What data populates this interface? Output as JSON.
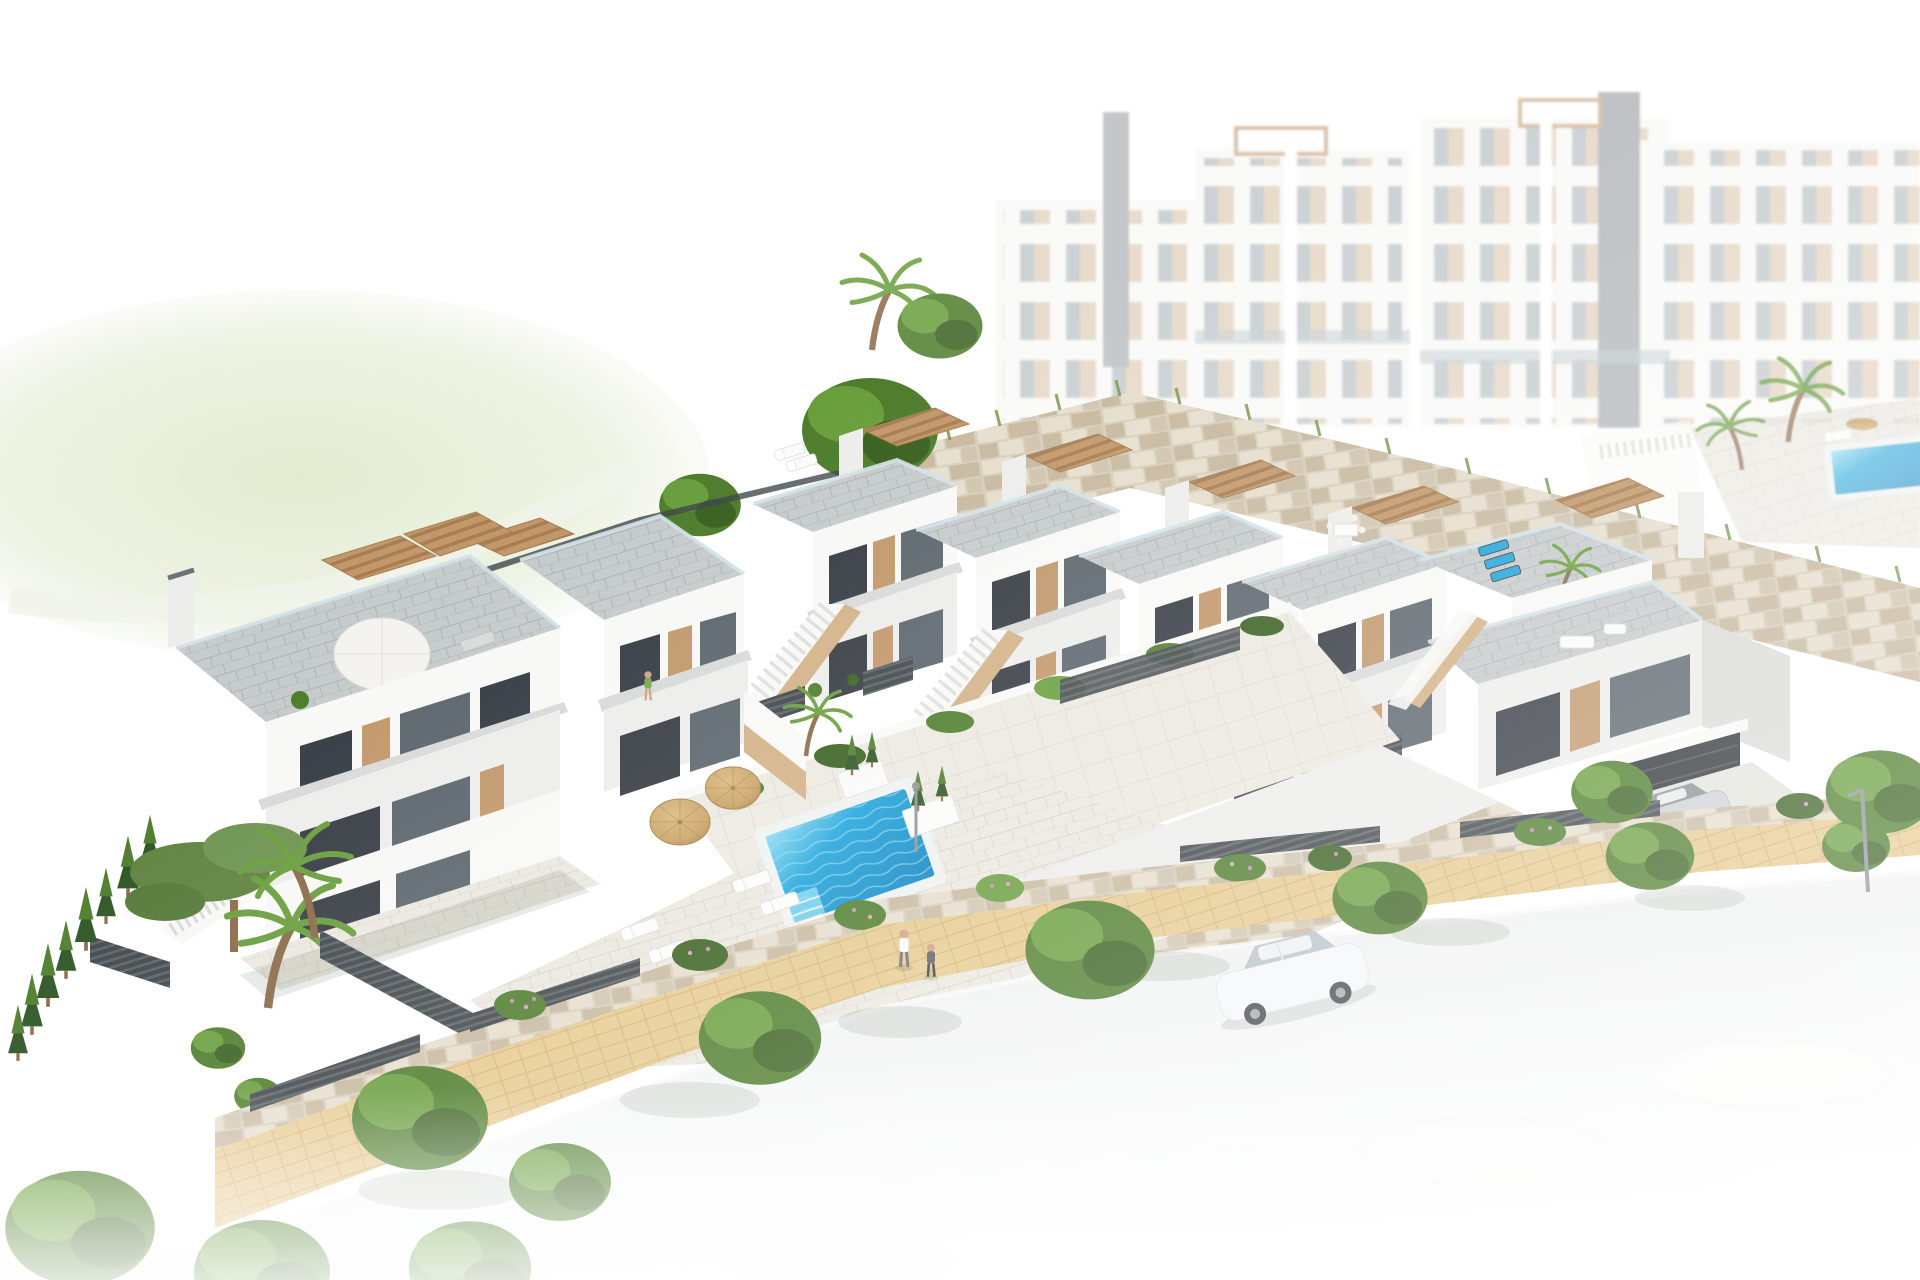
{
  "meta": {
    "type": "architectural-aerial-render",
    "description": "Aerial 3D architectural visualization of a white Mediterranean hillside townhouse development: five stepped townhouses with rooftop terraces and wooden pergolas, a separate two-unit block on the left, a communal courtyard with blue swimming pool, two straw parasols, white sun loungers on grass, beige stone retaining walls, landscaped gardens with palms, cypresses and flowering bushes, a sandy footpath, a fading white road with a white sedan, a silver coupe at a garage, and hazy white apartment towers with a second pool in the background.",
    "width_px": 1920,
    "height_px": 1280
  },
  "palette": {
    "background": "#ffffff",
    "wall_white": "#f8f8f6",
    "wall_shade": "#ededeb",
    "wall_dark": "#dbdbd7",
    "concrete_edge": "#d8dad9",
    "glass_dark": "#373d44",
    "glass_mid": "#5d666e",
    "glass_light": "#a7b5bd",
    "glass_rail": "#d3e2e8",
    "wood": "#c2986b",
    "wood_light": "#d3b288",
    "wood_dark": "#a67e52",
    "deck_gray": "#c6cbcc",
    "deck_line": "#aeb4b5",
    "deck_light": "#eae8e0",
    "deck_light_line": "#d8d4c6",
    "stone_base": "#d7cdba",
    "stone_light": "#e6decd",
    "stone_mid": "#c8b99f",
    "tile_light": "#ece9e1",
    "tile_line": "#dbd7ca",
    "fence_dark": "#40464a",
    "fence_light": "#5c6367",
    "grass": "#6da332",
    "grass_dark": "#5a8f26",
    "grass_light": "#82b944",
    "tree": "#4e7d2c",
    "tree_dark": "#3a6120",
    "tree_light": "#699e3d",
    "cypress": "#2d5423",
    "trunk": "#8a6a48",
    "pool_blue": "#1ea4da",
    "pool_deep": "#0d82c0",
    "pool_light": "#8edcf4",
    "pool_rim": "#eef2f1",
    "umbrella": "#c9a264",
    "umbrella_dark": "#a5804b",
    "sand": "#e7cb90",
    "sand_line": "#d3b579",
    "road": "#eaeded",
    "car_white": "#f6f7f8",
    "car_glass": "#b9c3c9",
    "car_silver": "#ced1d4",
    "skin": "#cfa183",
    "step": "#d9d9d5",
    "lamp": "#8d9397",
    "apt_beige": "#d9c4a8",
    "apt_glass": "#a8b2b8"
  },
  "scene": {
    "background": {
      "apartment_towers": 4,
      "elevator_shafts": 2,
      "roof_pergola_frames": 2,
      "secondary_pool": 1,
      "secondary_pool_parasol": 1,
      "background_palms": 3
    },
    "midground": {
      "townhouse_row_units": 5,
      "left_block_units": 2,
      "rooftop_pergolas": 8,
      "roof_parasol": 1,
      "stone_retaining_walls": 3,
      "garage_doors": 1,
      "street_lamps": 2
    },
    "courtyard": {
      "swimming_pool": 1,
      "straw_parasols": 2,
      "white_sun_loungers": 6,
      "gray_roof_loungers": 2,
      "blue_roof_loungers": 3,
      "grass_lawn": 1,
      "planter_boxes": 2,
      "sunbathing_person": 1
    },
    "foreground": {
      "sand_path": 1,
      "road": 1,
      "white_sedan": 1,
      "silver_coupe": 1,
      "ghost_cars": 3,
      "walking_people": 2,
      "terrace_person": 1,
      "palm_trees": 5,
      "cypress_trees": 8,
      "round_trees": 14,
      "flowering_bushes": 8,
      "dark_slatted_fences": true
    }
  }
}
